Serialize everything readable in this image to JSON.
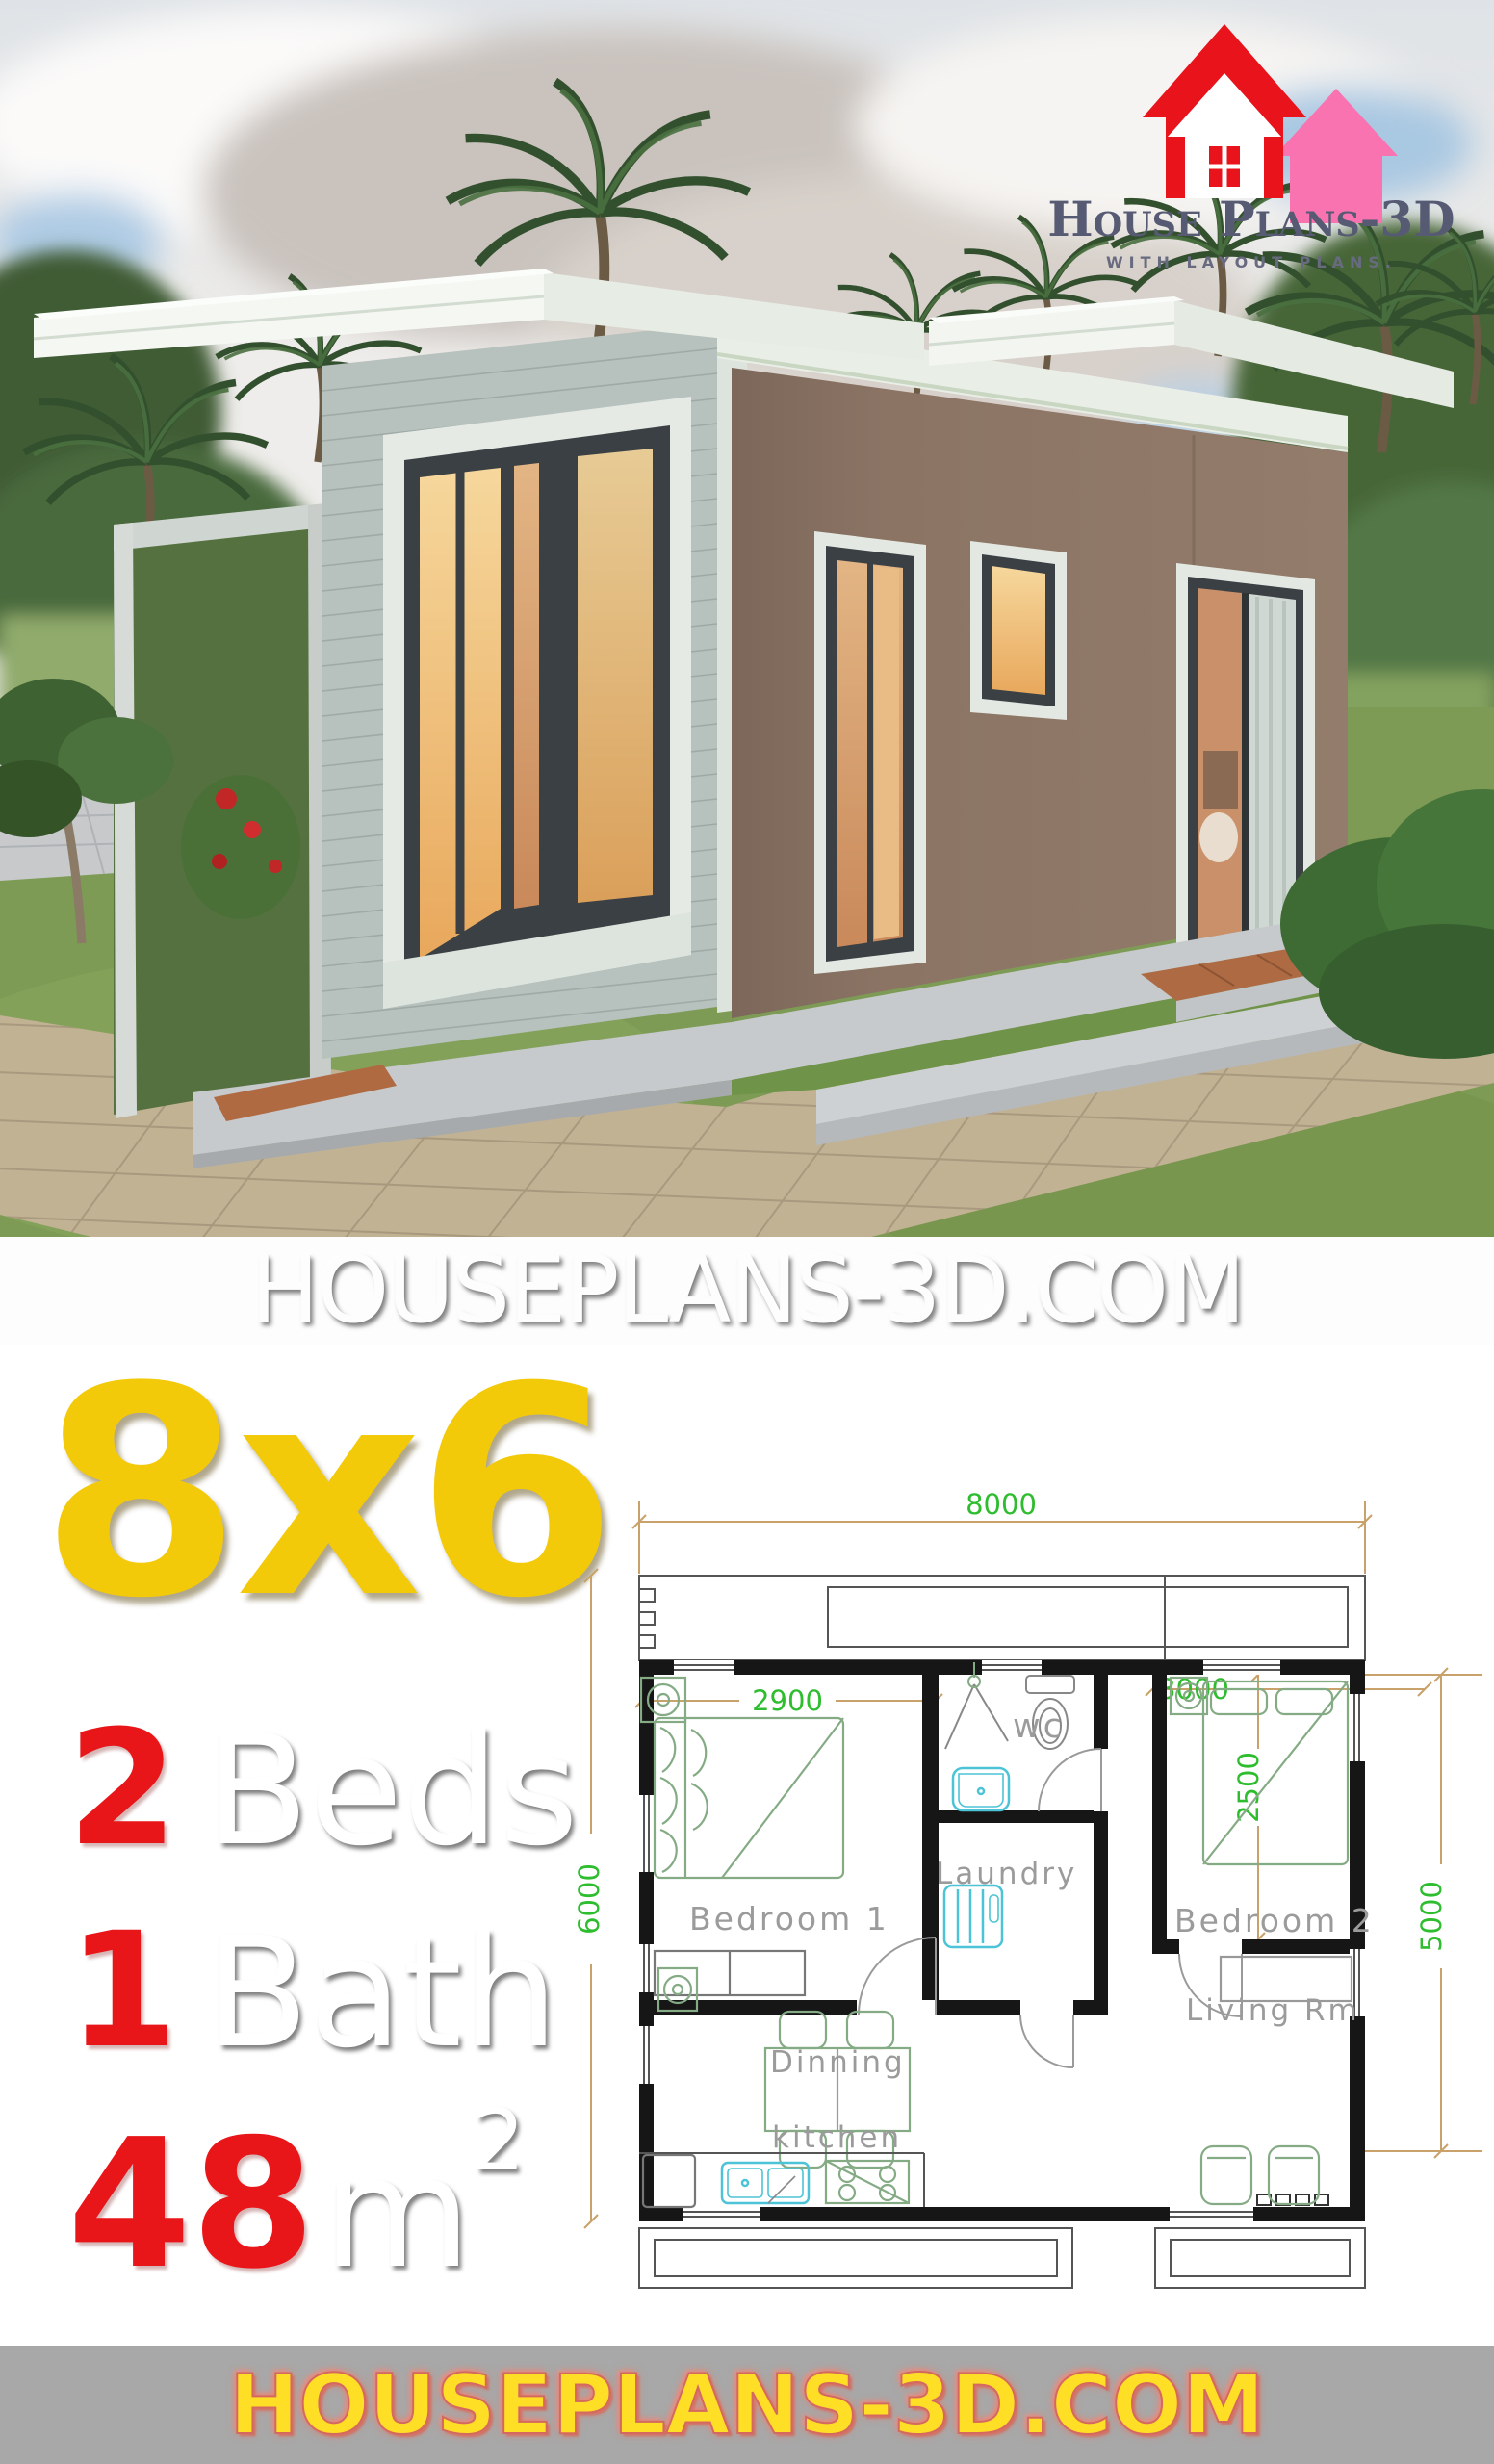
{
  "brand": {
    "logo_title": "House Plans-3D",
    "logo_tagline": "WITH LAYOUT PLANS.",
    "watermark": "HOUSEPLANS-3D.COM",
    "footer_url": "HOUSEPLANS-3D.COM",
    "logo_icon": "house-icon"
  },
  "colors": {
    "accent_yellow": "#F3CA0A",
    "accent_red": "#E81519",
    "footer_bg": "#A8A8A8",
    "footer_text": "#FFDF26",
    "dim_text_green": "#2EBD2E",
    "dim_line_tan": "#C8A26A",
    "logo_red": "#E8131B",
    "logo_pink": "#F873B0",
    "plan_wall": "#161616",
    "fixture_cyan": "#4CC3D6",
    "furniture_green": "#85AB85"
  },
  "specs": {
    "plot_size": "8x6",
    "rows": [
      {
        "value": "2",
        "label": "Beds",
        "sup": ""
      },
      {
        "value": "1",
        "label": "Bath",
        "sup": ""
      },
      {
        "value": "48",
        "label": "m",
        "sup": "2"
      }
    ]
  },
  "floor_plan": {
    "rooms": {
      "bedroom1": "Bedroom 1",
      "wc": "wc",
      "laundry": "Laundry",
      "bedroom2": "Bedroom 2",
      "living": "Living Rm",
      "dinning": "Dinning",
      "kitchen": "kitchen"
    },
    "dimensions": {
      "width_total": "8000",
      "depth_total": "6000",
      "depth_right": "5000",
      "bedroom1_width": "2900",
      "bedroom2_width": "3000",
      "bedroom2_depth": "2500"
    }
  }
}
